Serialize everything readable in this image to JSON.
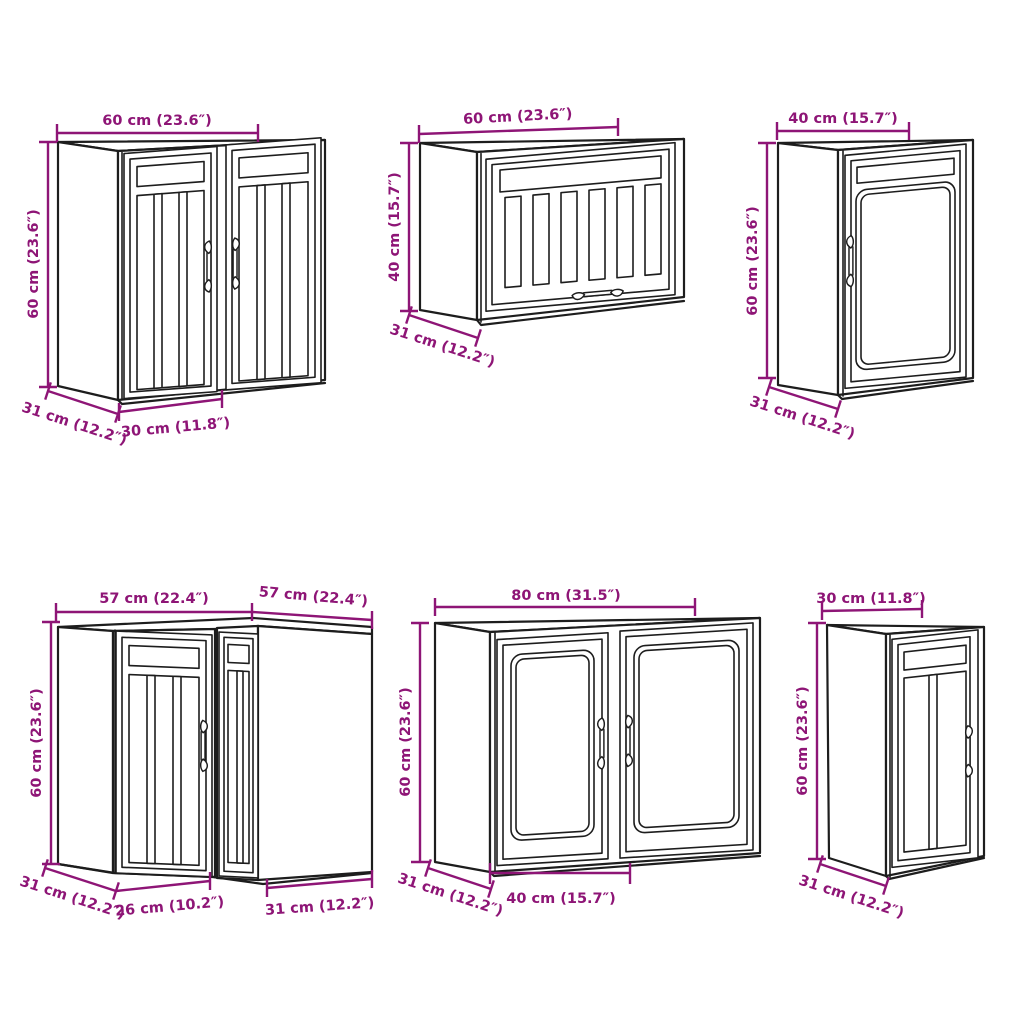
{
  "diagram": {
    "background_color": "#FFFFFF",
    "drawing_line_color": "#1D1D1D",
    "dimension_color": "#8E1576",
    "cabinets": [
      {
        "dims": {
          "width": "60 cm (23.6″)",
          "height": "60 cm (23.6″)",
          "depth": "31 cm (12.2″)",
          "door_width": "30 cm (11.8″)"
        }
      },
      {
        "dims": {
          "width": "60 cm (23.6″)",
          "height": "40 cm (15.7″)",
          "depth": "31 cm (12.2″)"
        }
      },
      {
        "dims": {
          "width": "40 cm (15.7″)",
          "height": "60 cm (23.6″)",
          "depth": "31 cm (12.2″)"
        }
      },
      {
        "dims": {
          "width_left": "57 cm (22.4″)",
          "width_right": "57 cm (22.4″)",
          "height": "60 cm (23.6″)",
          "depth_left": "31 cm (12.2″)",
          "door_width": "26 cm (10.2″)",
          "depth_right": "31 cm (12.2″)"
        }
      },
      {
        "dims": {
          "width": "80 cm (31.5″)",
          "height": "60 cm (23.6″)",
          "depth": "31 cm (12.2″)",
          "door_width": "40 cm (15.7″)"
        }
      },
      {
        "dims": {
          "width": "30 cm (11.8″)",
          "height": "60 cm (23.6″)",
          "depth": "31 cm (12.2″)"
        }
      }
    ]
  }
}
